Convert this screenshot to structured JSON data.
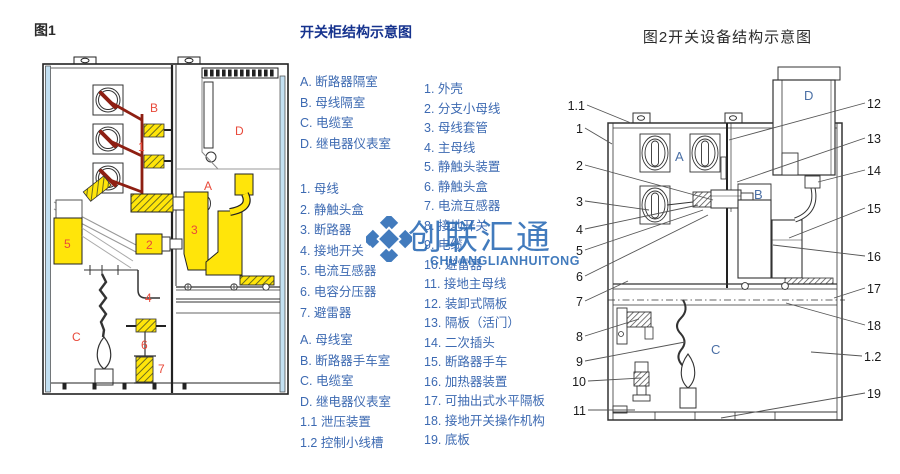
{
  "fig1": {
    "caption": "图1",
    "labels": {
      "B": "B",
      "one": "1",
      "D": "D",
      "A": "A",
      "two": "2",
      "three": "3",
      "five": "5",
      "four": "4",
      "six": "6",
      "seven": "7",
      "C": "C"
    }
  },
  "legend1": {
    "title": "开关柜结构示意图",
    "rooms": [
      "A. 断路器隔室",
      "B. 母线隔室",
      "C. 电缆室",
      "D. 继电器仪表室"
    ],
    "parts": [
      "1. 母线",
      "2. 静触头盒",
      "3. 断路器",
      "4. 接地开关",
      "5. 电流互感器",
      "6. 电容分压器",
      "7. 避雷器"
    ],
    "rooms2": [
      "A. 母线室",
      "B. 断路器手车室",
      "C. 电缆室",
      "D. 继电器仪表室",
      "1.1 泄压装置",
      "1.2 控制小线槽"
    ]
  },
  "legend2": {
    "items": [
      "1. 外壳",
      "2. 分支小母线",
      "3. 母线套管",
      "4. 主母线",
      "5. 静触头装置",
      "6. 静触头盒",
      "7. 电流互感器",
      "8. 接地开关",
      "9. 电缆",
      "10. 避雷器",
      "11. 接地主母线",
      "12. 装卸式隔板",
      "13. 隔板（活门）",
      "14. 二次插头",
      "15. 断路器手车",
      "16. 加热器装置",
      "17. 可抽出式水平隔板",
      "18. 接地开关操作机构",
      "19. 底板"
    ]
  },
  "fig2": {
    "title": "图2开关设备结构示意图",
    "letters": {
      "A": "A",
      "B": "B",
      "C": "C",
      "D": "D"
    },
    "callouts_left": [
      "1.1",
      "1",
      "2",
      "3",
      "4",
      "5",
      "6",
      "7",
      "8",
      "9",
      "10",
      "11"
    ],
    "callouts_right": [
      "12",
      "13",
      "14",
      "15",
      "16",
      "17",
      "18",
      "1.2",
      "19"
    ]
  },
  "watermark": {
    "cn": "创联汇通",
    "en": "CHUANGLIANHUITONG"
  },
  "colors": {
    "legend_blue": "#3d6ab2",
    "title_blue": "#16338e",
    "label_red": "#e8493a",
    "busbar_dark_red": "#8e1f12",
    "part_yellow": "#ffe50a",
    "panel_light_blue": "#c3e0f2",
    "watermark_blue": "#2e6db6"
  }
}
